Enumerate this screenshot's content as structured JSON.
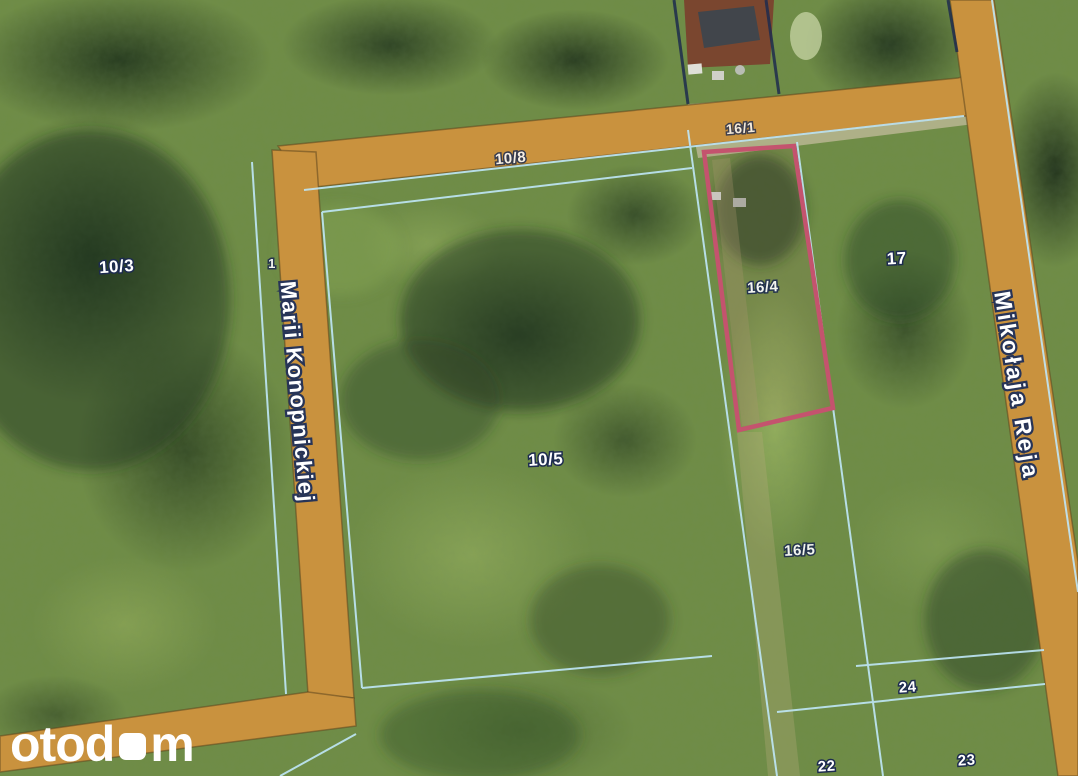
{
  "map": {
    "type": "satellite-cadastral-map",
    "colors": {
      "road": "#c9923e",
      "road_edge": "#5d461e",
      "boundary": "#bfe7f8",
      "boundary_dark": "#1e2c4e",
      "highlight": "#c4536e",
      "label_text": "#ffffff",
      "label_outline": "#1d2b4f"
    },
    "streets": [
      {
        "name": "Marii Konopnickiej"
      },
      {
        "name": "Mikołaja Reja"
      }
    ],
    "parcels": [
      {
        "number": "10/3"
      },
      {
        "number": "10/8"
      },
      {
        "number": "16/1"
      },
      {
        "number": "1"
      },
      {
        "number": "16/4",
        "highlighted": true
      },
      {
        "number": "17"
      },
      {
        "number": "10/5"
      },
      {
        "number": "16/5"
      },
      {
        "number": "24"
      },
      {
        "number": "22"
      },
      {
        "number": "23"
      }
    ]
  },
  "watermark": {
    "brand": "otodom",
    "text_before_square": "otod",
    "text_after_square": "m",
    "color": "#ffffff"
  }
}
